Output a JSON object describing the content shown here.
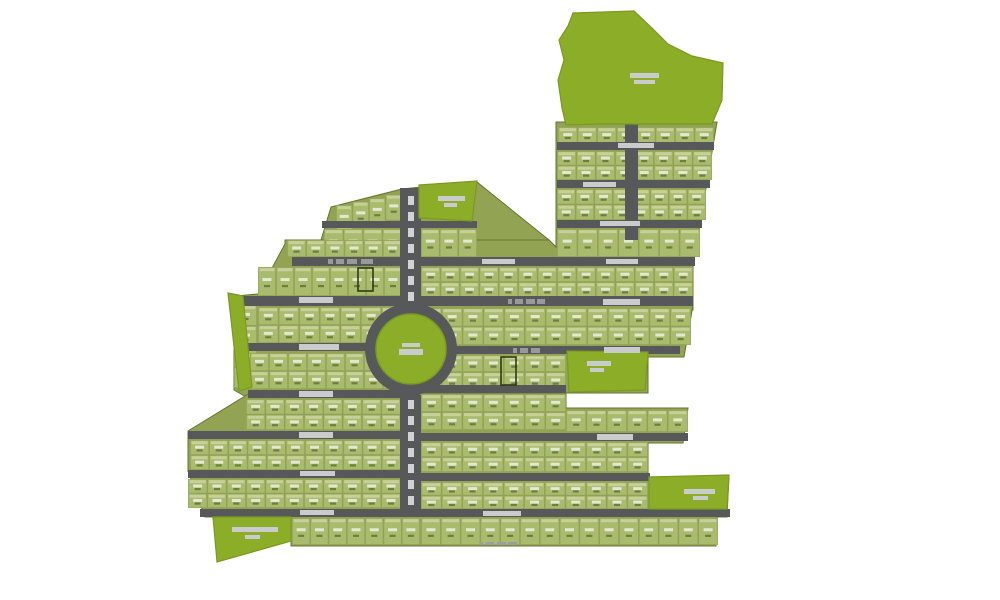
{
  "meta": {
    "title": "residential-plotted-development-master-plan",
    "canvas": {
      "width": 1000,
      "height": 600
    }
  },
  "colors": {
    "background": "#ffffff",
    "block_base": "#93a354",
    "block_edge": "#64742f",
    "plot_fill": "#a9bb6c",
    "plot_stroke": "#91a257",
    "plot_header": "#c6d098",
    "plot_label": "#e3e8d3",
    "plot_submark": "#6e7e41",
    "open_space": "#8cad27",
    "open_space_edge": "#7a9a22",
    "road": "#57585a",
    "road_label_strip": "#c9cbcd",
    "road_label_dash": "#97999b",
    "median_dash": "#d0d2d4",
    "highlight_stroke": "#2f3b17",
    "scale_mark": "#9b9da0"
  },
  "base_polygons": [
    {
      "name": "block-base-top-right",
      "points": "556,122 717,122 694,260 556,260"
    },
    {
      "name": "block-base-top-center",
      "points": "331,207 402,189 421,187 477,182 549,240 556,247 556,260 322,260 321,240"
    },
    {
      "name": "block-base-middle",
      "points": "285,240 549,240 556,247 693,247 693,310 236,310 236,296 258,294 285,244"
    },
    {
      "name": "block-base-west",
      "points": "236,305 402,305 402,398 248,398 234,390 234,305"
    },
    {
      "name": "block-base-east",
      "points": "421,305 693,305 684,357 648,357 648,393 421,393"
    },
    {
      "name": "block-base-south",
      "points": "250,393 566,393 566,408 688,408 683,443 648,443 648,477 729,476 727,517 717,517 716,546 291,546 291,517 205,517 188,471 188,431"
    }
  ],
  "open_spaces": [
    {
      "name": "open-space-north",
      "points": "573,13 634,11 652,28 668,44 692,56 723,63 722,100 712,124 598,124 566,125 562,108 558,80 564,60 559,40 568,26",
      "label_bars": [
        [
          630,
          73,
          29,
          5
        ],
        [
          634,
          80,
          21,
          4
        ]
      ]
    },
    {
      "name": "open-space-top-center",
      "points": "419,185 477,181 472,221 419,218",
      "label_bars": [
        [
          438,
          196,
          27,
          5
        ],
        [
          444,
          203,
          13,
          4
        ]
      ]
    },
    {
      "name": "open-space-east-mid",
      "points": "567,351 648,352 645,390 569,392",
      "label_bars": [
        [
          587,
          361,
          24,
          5
        ],
        [
          590,
          368,
          14,
          4
        ]
      ]
    },
    {
      "name": "open-space-south-east",
      "points": "649,477 729,475 727,509 649,509",
      "label_bars": [
        [
          684,
          489,
          31,
          5
        ],
        [
          693,
          496,
          15,
          4
        ]
      ]
    },
    {
      "name": "open-space-south-west",
      "points": "213,517 291,517 291,541 217,562",
      "label_bars": [
        [
          232,
          527,
          46,
          5
        ],
        [
          245,
          535,
          15,
          4
        ]
      ]
    },
    {
      "name": "open-space-west-sliver",
      "points": "228,293 243,296 252,387 239,391",
      "label_bars": []
    }
  ],
  "plot_bands": [
    {
      "x": 558,
      "y": 127,
      "w": 156,
      "h": 16,
      "rows": 1,
      "cols": 8
    },
    {
      "x": 557,
      "y": 151,
      "w": 155,
      "h": 29,
      "rows": 2,
      "cols": 8
    },
    {
      "x": 557,
      "y": 189,
      "w": 149,
      "h": 31,
      "rows": 2,
      "cols": 8
    },
    {
      "x": 557,
      "y": 229,
      "w": 143,
      "h": 28,
      "rows": 1,
      "cols": 7
    },
    {
      "x": 336,
      "y": 205,
      "w": 66,
      "h": 26,
      "rows": 1,
      "cols": 4,
      "dy": -3.5
    },
    {
      "x": 324,
      "y": 229,
      "w": 78,
      "h": 28,
      "rows": 1,
      "cols": 4
    },
    {
      "x": 421,
      "y": 229,
      "w": 56,
      "h": 28,
      "rows": 1,
      "cols": 3
    },
    {
      "x": 287,
      "y": 240,
      "w": 115,
      "h": 17,
      "rows": 1,
      "cols": 6
    },
    {
      "x": 258,
      "y": 267,
      "w": 144,
      "h": 29,
      "rows": 1,
      "cols": 8
    },
    {
      "x": 421,
      "y": 267,
      "w": 272,
      "h": 30,
      "rows": 2,
      "cols": 14
    },
    {
      "x": 258,
      "y": 307,
      "w": 144,
      "h": 36,
      "rows": 2,
      "cols": 7
    },
    {
      "x": 421,
      "y": 308,
      "w": 270,
      "h": 37,
      "rows": 2,
      "cols": 13
    },
    {
      "x": 234,
      "y": 305,
      "w": 23,
      "h": 83,
      "rows": 4,
      "cols": 1
    },
    {
      "x": 250,
      "y": 353,
      "w": 152,
      "h": 36,
      "rows": 2,
      "cols": 8
    },
    {
      "x": 421,
      "y": 355,
      "w": 145,
      "h": 34,
      "rows": 2,
      "cols": 7
    },
    {
      "x": 246,
      "y": 399,
      "w": 174,
      "h": 31,
      "rows": 2,
      "cols": 9
    },
    {
      "x": 421,
      "y": 394,
      "w": 145,
      "h": 36,
      "rows": 2,
      "cols": 7
    },
    {
      "x": 566,
      "y": 410,
      "w": 122,
      "h": 22,
      "rows": 1,
      "cols": 6
    },
    {
      "x": 190,
      "y": 440,
      "w": 230,
      "h": 30,
      "rows": 2,
      "cols": 12
    },
    {
      "x": 421,
      "y": 442,
      "w": 227,
      "h": 30,
      "rows": 2,
      "cols": 11
    },
    {
      "x": 188,
      "y": 479,
      "w": 232,
      "h": 29,
      "rows": 2,
      "cols": 12
    },
    {
      "x": 421,
      "y": 482,
      "w": 227,
      "h": 27,
      "rows": 2,
      "cols": 11
    },
    {
      "x": 292,
      "y": 518,
      "w": 128,
      "h": 27,
      "rows": 1,
      "cols": 7
    },
    {
      "x": 421,
      "y": 518,
      "w": 297,
      "h": 27,
      "rows": 1,
      "cols": 15
    }
  ],
  "roads": {
    "horizontal": [
      [
        557,
        142,
        157,
        8
      ],
      [
        557,
        180,
        153,
        8
      ],
      [
        557,
        220,
        145,
        8
      ],
      [
        322,
        221,
        155,
        7
      ],
      [
        292,
        257,
        110,
        9
      ],
      [
        421,
        257,
        274,
        9
      ],
      [
        236,
        296,
        457,
        10
      ],
      [
        234,
        343,
        168,
        8
      ],
      [
        421,
        346,
        259,
        8
      ],
      [
        248,
        390,
        172,
        8
      ],
      [
        421,
        385,
        145,
        8
      ],
      [
        188,
        431,
        232,
        8
      ],
      [
        421,
        433,
        267,
        8
      ],
      [
        188,
        470,
        232,
        8
      ],
      [
        421,
        473,
        229,
        8
      ],
      [
        200,
        509,
        530,
        8
      ]
    ],
    "vertical": [
      [
        400,
        188,
        21,
        118
      ],
      [
        400,
        395,
        21,
        122
      ],
      [
        625,
        124,
        13,
        116
      ]
    ]
  },
  "roundabout": {
    "cx": 411,
    "cy": 349,
    "r_outer": 46,
    "r_island": 35,
    "label_bars": [
      [
        402,
        343,
        18,
        4
      ],
      [
        399,
        349,
        24,
        6
      ]
    ]
  },
  "median_dash_runs": [
    {
      "x": 408,
      "w": 6,
      "from": 196,
      "to": 292,
      "step": 16,
      "h": 9
    },
    {
      "x": 408,
      "w": 6,
      "from": 400,
      "to": 496,
      "step": 16,
      "h": 9
    }
  ],
  "road_label_strips": [
    [
      618,
      143,
      36,
      5
    ],
    [
      583,
      182,
      33,
      5
    ],
    [
      600,
      221,
      40,
      5
    ],
    [
      482,
      259,
      33,
      5
    ],
    [
      606,
      259,
      32,
      5
    ],
    [
      299,
      297,
      34,
      6
    ],
    [
      603,
      299,
      37,
      6
    ],
    [
      299,
      344,
      40,
      6
    ],
    [
      604,
      347,
      36,
      6
    ],
    [
      299,
      391,
      34,
      6
    ],
    [
      299,
      432,
      34,
      6
    ],
    [
      597,
      434,
      36,
      6
    ],
    [
      300,
      471,
      35,
      5
    ],
    [
      300,
      510,
      34,
      5
    ],
    [
      483,
      511,
      38,
      5
    ]
  ],
  "road_label_dash_groups": [
    {
      "y": 259,
      "h": 5,
      "xs": [
        328,
        336,
        347,
        361
      ],
      "ws": [
        5,
        8,
        10,
        12
      ]
    },
    {
      "y": 299,
      "h": 5,
      "xs": [
        508,
        515,
        526,
        537
      ],
      "ws": [
        4,
        8,
        9,
        8
      ]
    },
    {
      "y": 348,
      "h": 5,
      "xs": [
        513,
        520,
        531
      ],
      "ws": [
        4,
        8,
        9
      ]
    }
  ],
  "highlighted_plots": [
    [
      358,
      268,
      15,
      23
    ],
    [
      501,
      357,
      15,
      28
    ]
  ],
  "scale_marks": {
    "y": 542,
    "h": 3,
    "xs": [
      480,
      486,
      497,
      508
    ],
    "ws": [
      3,
      8,
      9,
      9
    ]
  }
}
